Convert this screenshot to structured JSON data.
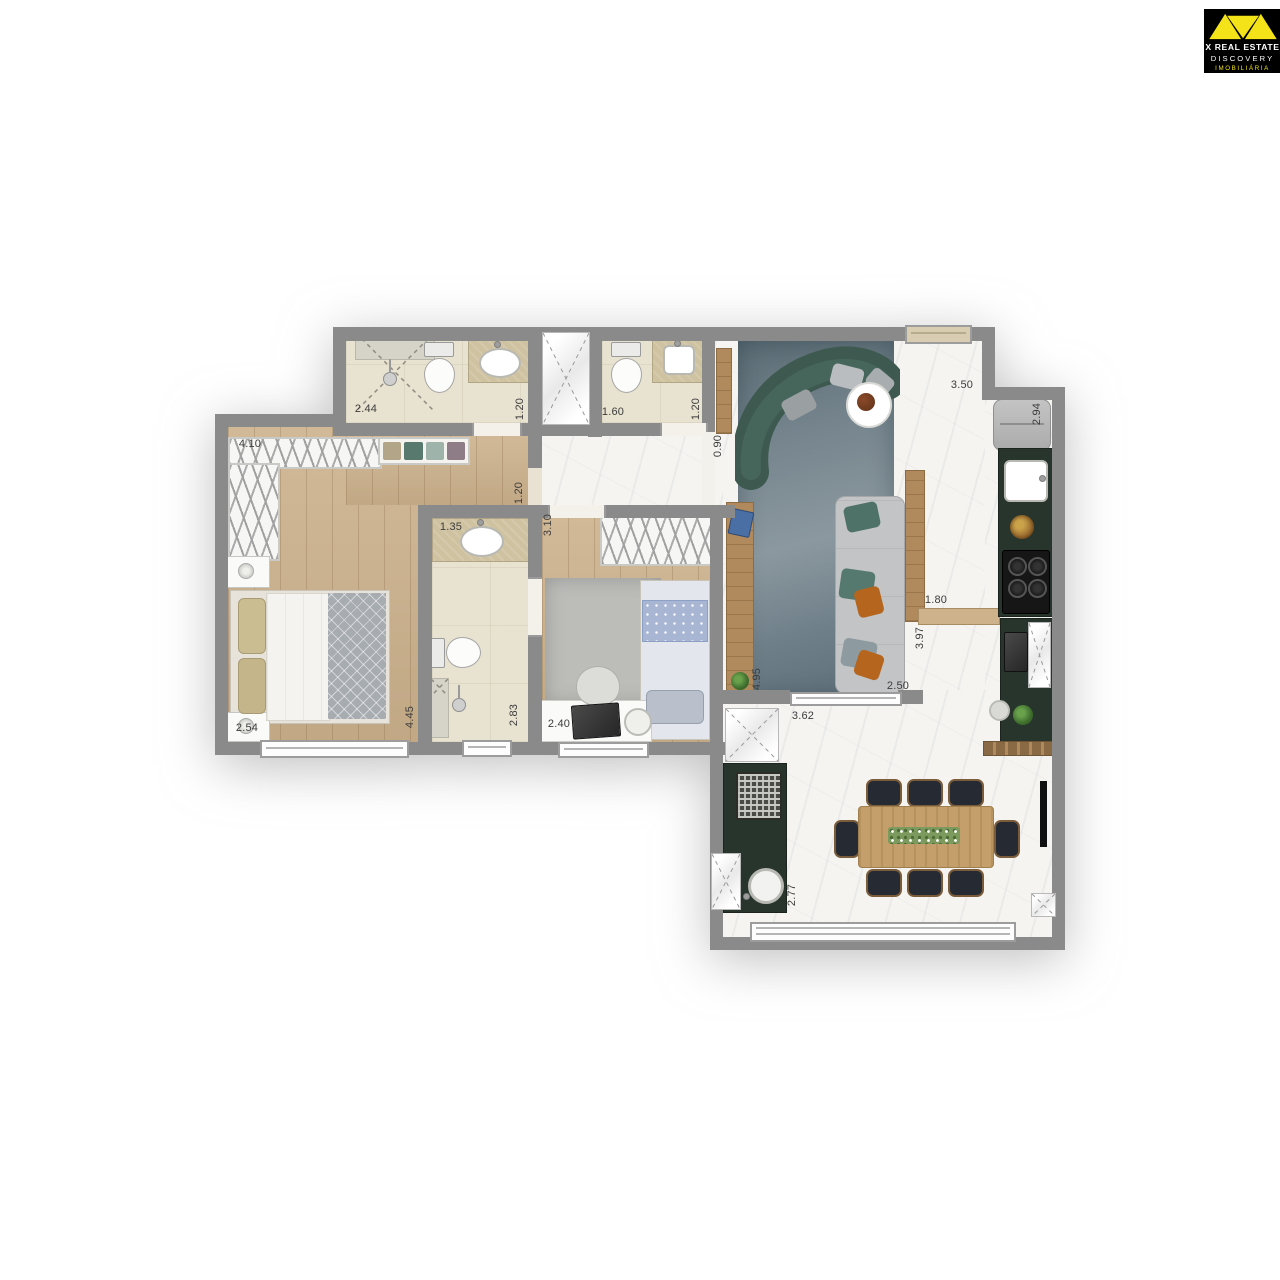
{
  "logo": {
    "title": "X REAL ESTATE",
    "subtitle": "DISCOVERY",
    "tagline": "IMOBILIÁRIA",
    "triangle_color": "#f4e318",
    "background": "#000000"
  },
  "colors": {
    "wall": "#8a8a8a",
    "bath_tile": "#e8e2d0",
    "wood_floor": "#ccb18c",
    "marble_floor": "#f5f4f1",
    "counter_green": "#28352d",
    "rug_blue_gray": "#76858e",
    "sofa_green": "#3e5a50",
    "table_wood": "#c49f6b",
    "chair_dark": "#262b33",
    "vanity_stone": "#cfc2a0"
  },
  "plan": {
    "dims": [
      {
        "id": "bath1-width",
        "value": "2.44"
      },
      {
        "id": "bath1-depth",
        "value": "1.20"
      },
      {
        "id": "bath2-width",
        "value": "1.60"
      },
      {
        "id": "bath2-depth",
        "value": "1.20"
      },
      {
        "id": "living-entrance",
        "value": "0.90"
      },
      {
        "id": "living-top-width",
        "value": "3.50"
      },
      {
        "id": "kitchen-depth",
        "value": "2.94"
      },
      {
        "id": "closet-run",
        "value": "4.10"
      },
      {
        "id": "hall-width",
        "value": "1.20"
      },
      {
        "id": "bath3-width",
        "value": "1.35"
      },
      {
        "id": "bedroom2-depth",
        "value": "3.10"
      },
      {
        "id": "living-niche",
        "value": "1.80"
      },
      {
        "id": "kitchen-passage",
        "value": "3.97"
      },
      {
        "id": "master-width",
        "value": "2.54"
      },
      {
        "id": "master-length",
        "value": "4.45"
      },
      {
        "id": "bath3-length",
        "value": "2.83"
      },
      {
        "id": "bedroom2-width",
        "value": "2.40"
      },
      {
        "id": "living-length",
        "value": "4.95"
      },
      {
        "id": "sofa-wall",
        "value": "2.50"
      },
      {
        "id": "dining-width",
        "value": "3.62"
      },
      {
        "id": "dining-depth",
        "value": "2.77"
      }
    ]
  }
}
